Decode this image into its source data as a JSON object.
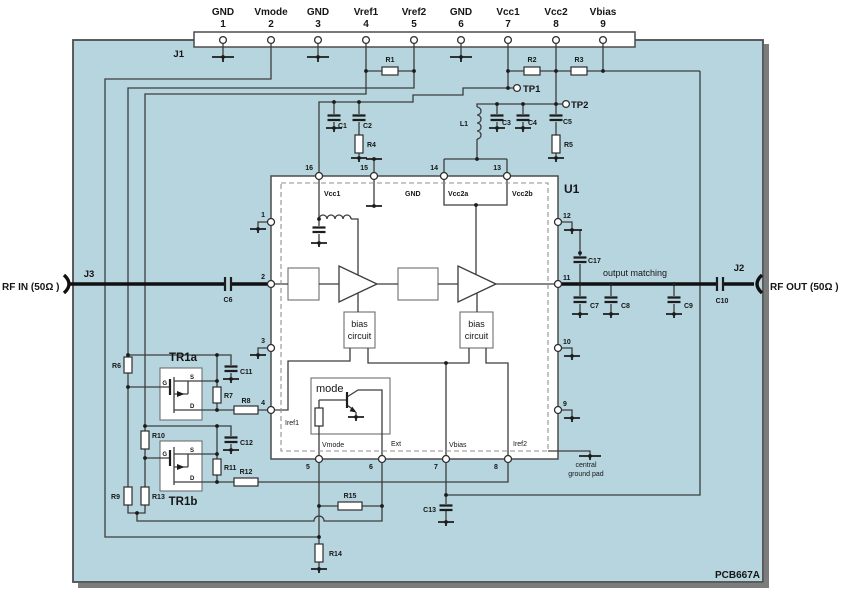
{
  "board": {
    "name": "PCB667A"
  },
  "connectors": {
    "j1": "J1",
    "j2": "J2",
    "j3": "J3"
  },
  "ports": {
    "rf_in": "RF IN (50Ω )",
    "rf_out": "RF OUT (50Ω )"
  },
  "test_points": {
    "tp1": "TP1",
    "tp2": "TP2"
  },
  "j1_pins": [
    {
      "name": "GND",
      "num": "1"
    },
    {
      "name": "Vmode",
      "num": "2"
    },
    {
      "name": "GND",
      "num": "3"
    },
    {
      "name": "Vref1",
      "num": "4"
    },
    {
      "name": "Vref2",
      "num": "5"
    },
    {
      "name": "GND",
      "num": "6"
    },
    {
      "name": "Vcc1",
      "num": "7"
    },
    {
      "name": "Vcc2",
      "num": "8"
    },
    {
      "name": "Vbias",
      "num": "9"
    }
  ],
  "res": {
    "r1": "R1",
    "r2": "R2",
    "r3": "R3",
    "r4": "R4",
    "r5": "R5",
    "r6": "R6",
    "r7": "R7",
    "r8": "R8",
    "r9": "R9",
    "r10": "R10",
    "r11": "R11",
    "r12": "R12",
    "r13": "R13",
    "r14": "R14",
    "r15": "R15"
  },
  "cap": {
    "c1": "C1",
    "c2": "C2",
    "c3": "C3",
    "c4": "C4",
    "c5": "C5",
    "c6": "C6",
    "c7": "C7",
    "c8": "C8",
    "c9": "C9",
    "c10": "C10",
    "c11": "C11",
    "c12": "C12",
    "c13": "C13",
    "c17": "C17"
  },
  "ind": {
    "l1": "L1"
  },
  "ic": {
    "ref": "U1",
    "pins": {
      "p1": "1",
      "p2": "2",
      "p3": "3",
      "p4": "4",
      "p5": "5",
      "p6": "6",
      "p7": "7",
      "p8": "8",
      "p9": "9",
      "p10": "10",
      "p11": "11",
      "p12": "12",
      "p13": "13",
      "p14": "14",
      "p15": "15",
      "p16": "16"
    },
    "labels": {
      "vcc1": "Vcc1",
      "gnd": "GND",
      "vcc2a": "Vcc2a",
      "vcc2b": "Vcc2b",
      "iref1": "Iref1",
      "vmode": "Vmode",
      "ext": "Ext",
      "vbias": "Vbias",
      "iref2": "Iref2",
      "mode": "mode",
      "bias1": "bias",
      "bias2": "circuit"
    }
  },
  "transistors": {
    "tr1a": "TR1a",
    "tr1b": "TR1b",
    "g": "G",
    "s": "S",
    "d": "D"
  },
  "annotations": {
    "output_matching": "output matching",
    "pad1": "central",
    "pad2": "ground pad"
  },
  "colors": {
    "board_fill": "#b6d5df",
    "board_border": "#4c4c4c",
    "wire": "#3d3d3d",
    "rf_line": "#101010",
    "component_fill": "#ffffff"
  }
}
